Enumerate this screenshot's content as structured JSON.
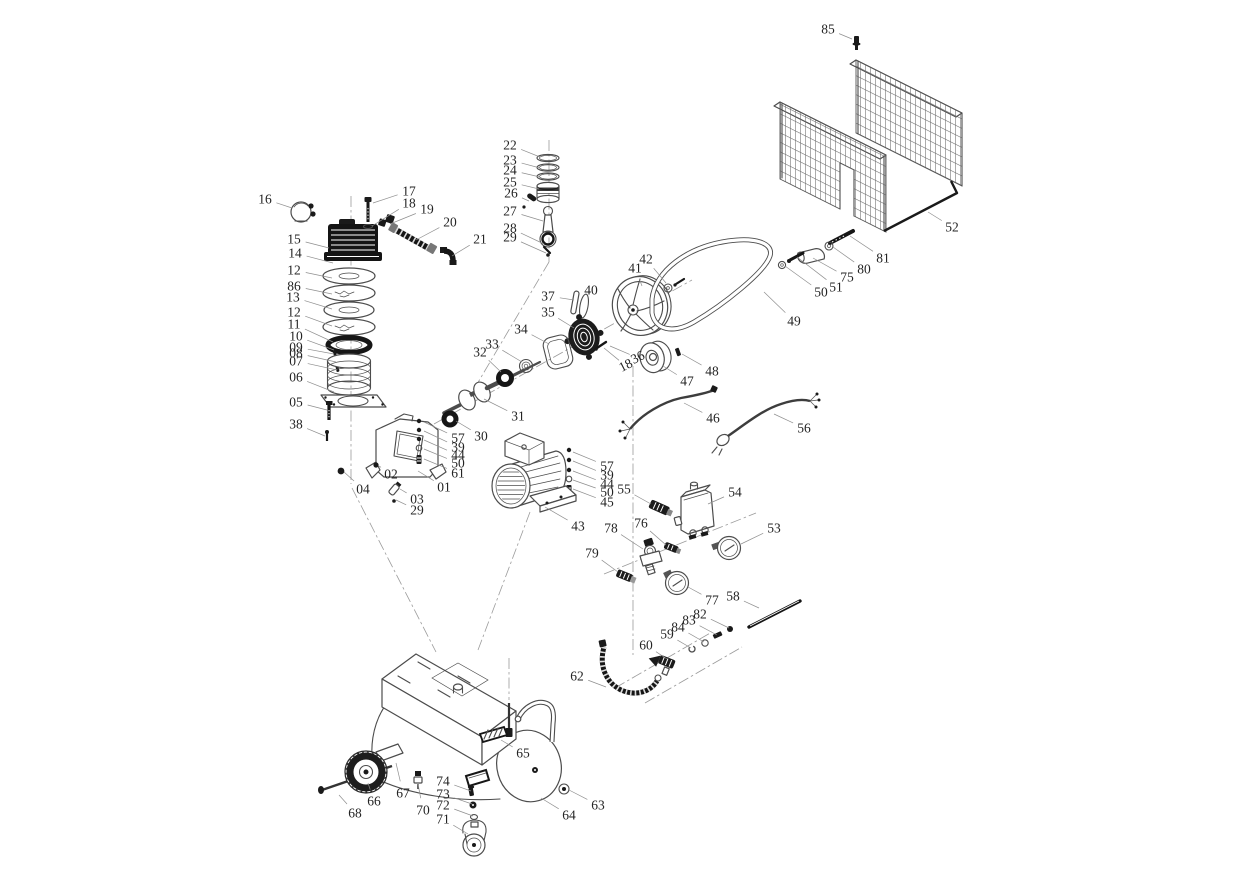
{
  "meta": {
    "title": "Air compressor exploded parts diagram",
    "width": 1242,
    "height": 872,
    "background_color": "#ffffff",
    "line_color": "#4c4c4c",
    "leader_color": "#8f8f8f",
    "label_color": "#242424",
    "dark_part_color": "#1a1a1a"
  },
  "labels": [
    {
      "t": "16",
      "x": 265,
      "y": 199,
      "bx": 292,
      "by": 208
    },
    {
      "t": "15",
      "x": 294,
      "y": 239,
      "bx": 329,
      "by": 248
    },
    {
      "t": "14",
      "x": 295,
      "y": 253,
      "bx": 333,
      "by": 263
    },
    {
      "t": "12",
      "x": 294,
      "y": 270,
      "bx": 332,
      "by": 278
    },
    {
      "t": "86",
      "x": 294,
      "y": 286,
      "bx": 332,
      "by": 294
    },
    {
      "t": "13",
      "x": 293,
      "y": 297,
      "bx": 332,
      "by": 309
    },
    {
      "t": "12",
      "x": 294,
      "y": 312,
      "bx": 332,
      "by": 326
    },
    {
      "t": "11",
      "x": 294,
      "y": 324,
      "bx": 333,
      "by": 342
    },
    {
      "t": "10",
      "x": 296,
      "y": 336,
      "bx": 334,
      "by": 350
    },
    {
      "t": "09",
      "x": 296,
      "y": 347,
      "bx": 334,
      "by": 354
    },
    {
      "t": "08",
      "x": 296,
      "y": 353,
      "bx": 336,
      "by": 362
    },
    {
      "t": "07",
      "x": 296,
      "y": 361,
      "bx": 337,
      "by": 370
    },
    {
      "t": "06",
      "x": 296,
      "y": 377,
      "bx": 334,
      "by": 392
    },
    {
      "t": "05",
      "x": 296,
      "y": 402,
      "bx": 327,
      "by": 410
    },
    {
      "t": "38",
      "x": 296,
      "y": 424,
      "bx": 325,
      "by": 436
    },
    {
      "t": "17",
      "x": 409,
      "y": 191,
      "bx": 373,
      "by": 203
    },
    {
      "t": "18",
      "x": 409,
      "y": 203,
      "bx": 372,
      "by": 226
    },
    {
      "t": "19",
      "x": 427,
      "y": 209,
      "bx": 390,
      "by": 224
    },
    {
      "t": "20",
      "x": 450,
      "y": 222,
      "bx": 416,
      "by": 240
    },
    {
      "t": "21",
      "x": 480,
      "y": 239,
      "bx": 452,
      "by": 256
    },
    {
      "t": "22",
      "x": 510,
      "y": 145,
      "bx": 540,
      "by": 157
    },
    {
      "t": "23",
      "x": 510,
      "y": 160,
      "bx": 540,
      "by": 168
    },
    {
      "t": "24",
      "x": 510,
      "y": 170,
      "bx": 540,
      "by": 177
    },
    {
      "t": "25",
      "x": 510,
      "y": 182,
      "bx": 539,
      "by": 189
    },
    {
      "t": "26",
      "x": 511,
      "y": 193,
      "bx": 529,
      "by": 201
    },
    {
      "t": "27",
      "x": 510,
      "y": 211,
      "bx": 543,
      "by": 221
    },
    {
      "t": "28",
      "x": 510,
      "y": 228,
      "bx": 544,
      "by": 244
    },
    {
      "t": "29",
      "x": 510,
      "y": 237,
      "bx": 546,
      "by": 253
    },
    {
      "t": "37",
      "x": 548,
      "y": 296,
      "bx": 574,
      "by": 300
    },
    {
      "t": "35",
      "x": 548,
      "y": 312,
      "bx": 574,
      "by": 328
    },
    {
      "t": "34",
      "x": 521,
      "y": 329,
      "bx": 549,
      "by": 344
    },
    {
      "t": "40",
      "x": 591,
      "y": 290,
      "bx": 586,
      "by": 302
    },
    {
      "t": "41",
      "x": 635,
      "y": 268,
      "bx": 642,
      "by": 286
    },
    {
      "t": "42",
      "x": 646,
      "y": 259,
      "bx": 666,
      "by": 283
    },
    {
      "t": "49",
      "x": 794,
      "y": 321,
      "bx": 764,
      "by": 292
    },
    {
      "t": "48",
      "x": 712,
      "y": 371,
      "bx": 682,
      "by": 354
    },
    {
      "t": "47",
      "x": 687,
      "y": 381,
      "bx": 663,
      "by": 366
    },
    {
      "t": "46",
      "x": 713,
      "y": 418,
      "bx": 684,
      "by": 403
    },
    {
      "t": "56",
      "x": 804,
      "y": 428,
      "bx": 774,
      "by": 414
    },
    {
      "t": "18",
      "x": 626,
      "y": 366,
      "r": -27,
      "s": 10,
      "bx": 604,
      "by": 348
    },
    {
      "t": "36",
      "x": 638,
      "y": 358,
      "r": -27,
      "s": 10,
      "bx": 610,
      "by": 346
    },
    {
      "t": "32",
      "x": 480,
      "y": 352,
      "bx": 501,
      "by": 372
    },
    {
      "t": "33",
      "x": 492,
      "y": 344,
      "bx": 522,
      "by": 362
    },
    {
      "t": "31",
      "x": 518,
      "y": 416,
      "bx": 484,
      "by": 399
    },
    {
      "t": "30",
      "x": 481,
      "y": 436,
      "bx": 456,
      "by": 421
    },
    {
      "t": "57",
      "x": 458,
      "y": 438,
      "bx": 424,
      "by": 422
    },
    {
      "t": "39",
      "x": 458,
      "y": 447,
      "bx": 424,
      "by": 431
    },
    {
      "t": "44",
      "x": 458,
      "y": 455,
      "bx": 424,
      "by": 440
    },
    {
      "t": "50",
      "x": 458,
      "y": 463,
      "bx": 424,
      "by": 449
    },
    {
      "t": "61",
      "x": 458,
      "y": 473,
      "bx": 424,
      "by": 459
    },
    {
      "t": "01",
      "x": 444,
      "y": 487,
      "bx": 418,
      "by": 471
    },
    {
      "t": "02",
      "x": 391,
      "y": 474,
      "bx": 379,
      "by": 466
    },
    {
      "t": "04",
      "x": 363,
      "y": 489,
      "bx": 344,
      "by": 472
    },
    {
      "t": "03",
      "x": 417,
      "y": 499,
      "bx": 400,
      "by": 489
    },
    {
      "t": "29",
      "x": 417,
      "y": 510,
      "bx": 396,
      "by": 500
    },
    {
      "t": "43",
      "x": 578,
      "y": 526,
      "bx": 545,
      "by": 507
    },
    {
      "t": "57",
      "x": 607,
      "y": 466,
      "bx": 573,
      "by": 452
    },
    {
      "t": "39",
      "x": 607,
      "y": 475,
      "bx": 573,
      "by": 461
    },
    {
      "t": "44",
      "x": 607,
      "y": 484,
      "bx": 573,
      "by": 471
    },
    {
      "t": "50",
      "x": 607,
      "y": 492,
      "bx": 573,
      "by": 480
    },
    {
      "t": "45",
      "x": 607,
      "y": 502,
      "bx": 573,
      "by": 489
    },
    {
      "t": "55",
      "x": 624,
      "y": 489,
      "bx": 651,
      "by": 504
    },
    {
      "t": "54",
      "x": 735,
      "y": 492,
      "bx": 708,
      "by": 504
    },
    {
      "t": "76",
      "x": 641,
      "y": 523,
      "bx": 666,
      "by": 545
    },
    {
      "t": "78",
      "x": 611,
      "y": 528,
      "bx": 643,
      "by": 549
    },
    {
      "t": "79",
      "x": 592,
      "y": 553,
      "bx": 618,
      "by": 572
    },
    {
      "t": "53",
      "x": 774,
      "y": 528,
      "bx": 741,
      "by": 544
    },
    {
      "t": "77",
      "x": 712,
      "y": 600,
      "bx": 688,
      "by": 587
    },
    {
      "t": "58",
      "x": 733,
      "y": 596,
      "bx": 759,
      "by": 608
    },
    {
      "t": "82",
      "x": 700,
      "y": 614,
      "bx": 729,
      "by": 628
    },
    {
      "t": "83",
      "x": 689,
      "y": 620,
      "bx": 717,
      "by": 635
    },
    {
      "t": "84",
      "x": 678,
      "y": 627,
      "bx": 704,
      "by": 642
    },
    {
      "t": "59",
      "x": 667,
      "y": 634,
      "bx": 691,
      "by": 648
    },
    {
      "t": "60",
      "x": 646,
      "y": 645,
      "bx": 667,
      "by": 659
    },
    {
      "t": "62",
      "x": 577,
      "y": 676,
      "bx": 606,
      "by": 687
    },
    {
      "t": "65",
      "x": 523,
      "y": 753,
      "bx": 501,
      "by": 740
    },
    {
      "t": "63",
      "x": 598,
      "y": 805,
      "bx": 569,
      "by": 790
    },
    {
      "t": "64",
      "x": 569,
      "y": 815,
      "bx": 541,
      "by": 798
    },
    {
      "t": "66",
      "x": 374,
      "y": 801,
      "bx": 368,
      "by": 783
    },
    {
      "t": "67",
      "x": 403,
      "y": 793,
      "bx": 396,
      "by": 763
    },
    {
      "t": "68",
      "x": 355,
      "y": 813,
      "bx": 339,
      "by": 795
    },
    {
      "t": "70",
      "x": 423,
      "y": 810,
      "bx": 418,
      "by": 784
    },
    {
      "t": "74",
      "x": 443,
      "y": 781,
      "bx": 471,
      "by": 791
    },
    {
      "t": "73",
      "x": 443,
      "y": 794,
      "bx": 472,
      "by": 804
    },
    {
      "t": "72",
      "x": 443,
      "y": 805,
      "bx": 473,
      "by": 816
    },
    {
      "t": "71",
      "x": 443,
      "y": 819,
      "bx": 468,
      "by": 834
    },
    {
      "t": "85",
      "x": 828,
      "y": 29,
      "bx": 852,
      "by": 39
    },
    {
      "t": "52",
      "x": 952,
      "y": 227,
      "bx": 928,
      "by": 212
    },
    {
      "t": "81",
      "x": 883,
      "y": 258,
      "bx": 850,
      "by": 236
    },
    {
      "t": "80",
      "x": 864,
      "y": 269,
      "bx": 833,
      "by": 247
    },
    {
      "t": "75",
      "x": 847,
      "y": 277,
      "bx": 813,
      "by": 258
    },
    {
      "t": "51",
      "x": 836,
      "y": 287,
      "bx": 797,
      "by": 257
    },
    {
      "t": "50",
      "x": 821,
      "y": 292,
      "bx": 785,
      "by": 266
    }
  ]
}
